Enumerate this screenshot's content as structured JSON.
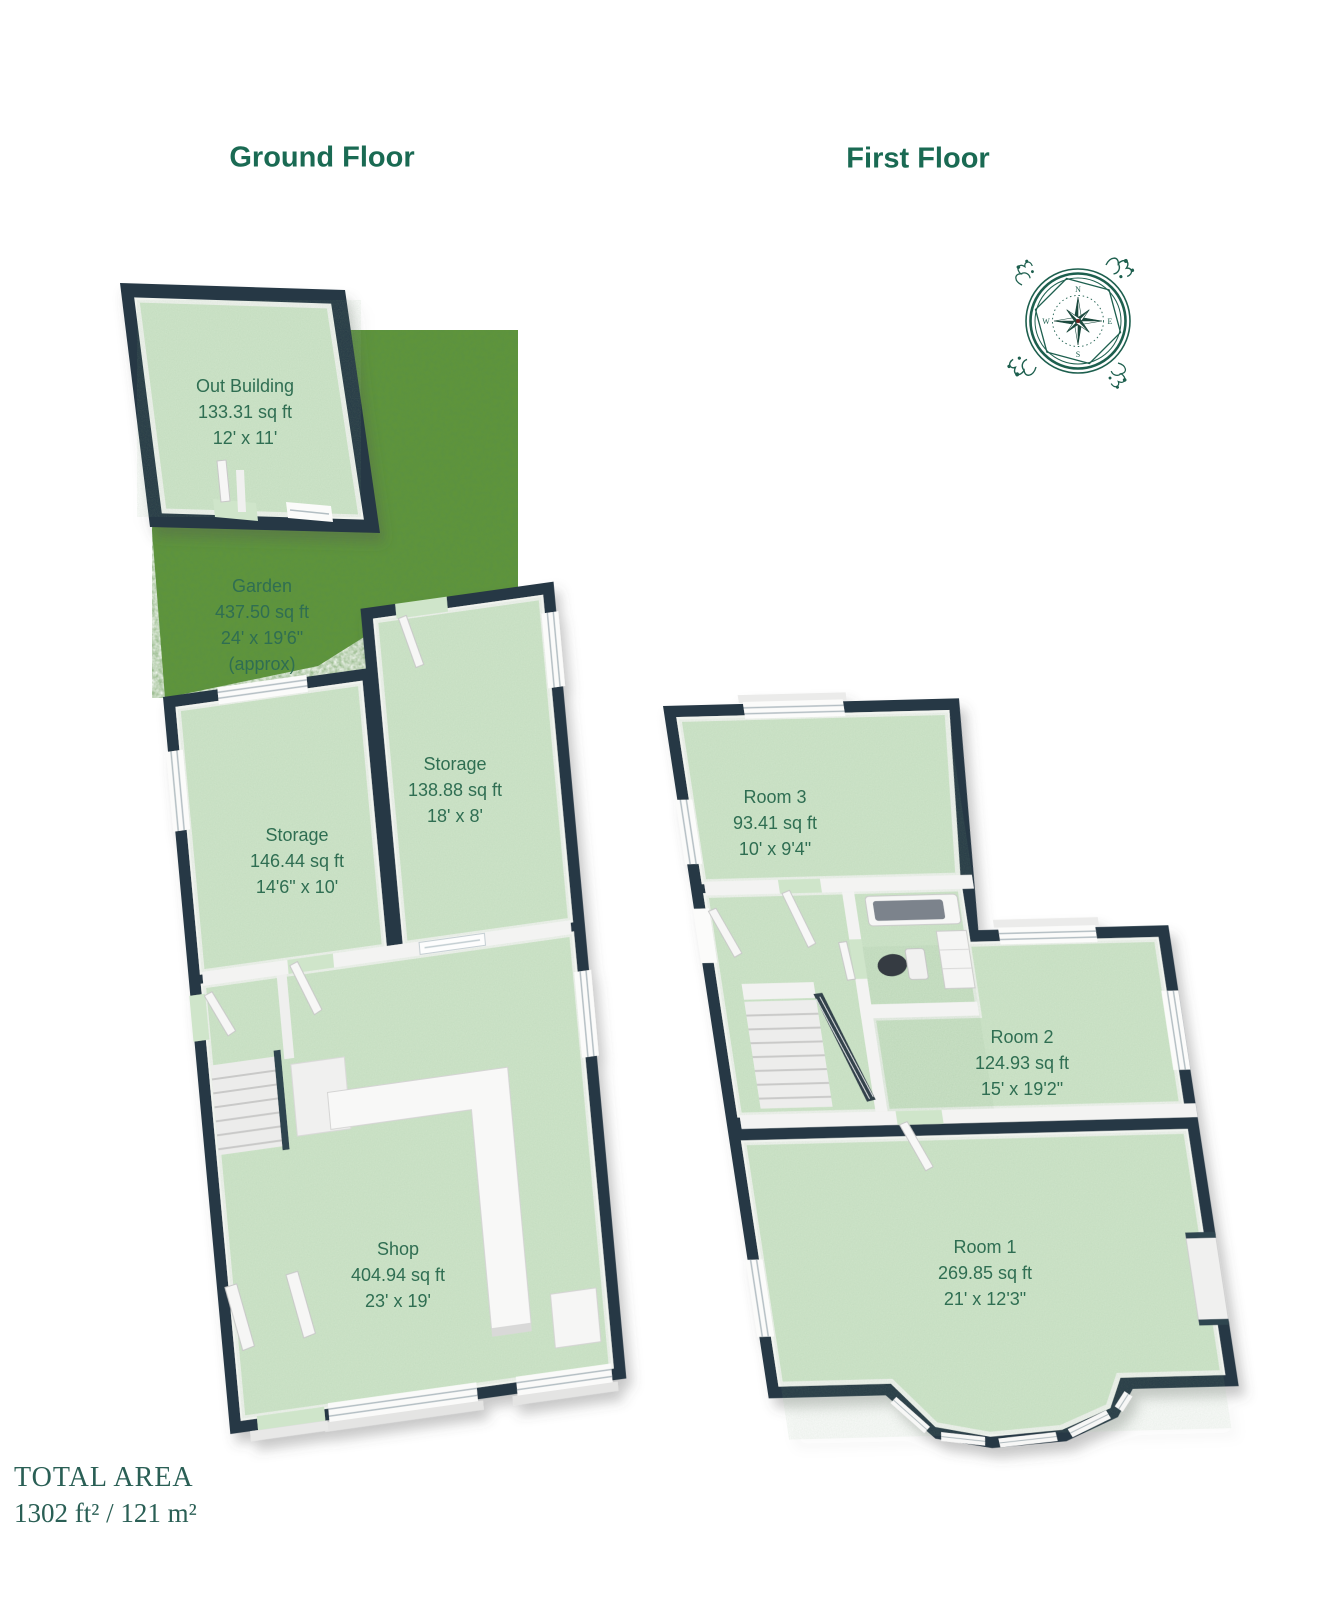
{
  "floors": [
    {
      "title": "Ground Floor",
      "rooms": [
        {
          "name": "Out Building",
          "area": "133.31 sq ft",
          "dims": "12' x 11'"
        },
        {
          "name": "Garden",
          "area": "437.50 sq ft",
          "dims": "24' x 19'6\"",
          "note": "(approx)"
        },
        {
          "name": "Storage",
          "area": "146.44 sq ft",
          "dims": "14'6\" x 10'"
        },
        {
          "name": "Storage",
          "area": "138.88 sq ft",
          "dims": "18' x 8'"
        },
        {
          "name": "Shop",
          "area": "404.94 sq ft",
          "dims": "23' x 19'"
        }
      ]
    },
    {
      "title": "First Floor",
      "rooms": [
        {
          "name": "Room 3",
          "area": "93.41 sq ft",
          "dims": "10' x 9'4\""
        },
        {
          "name": "Room 2",
          "area": "124.93 sq ft",
          "dims": "15' x 19'2\""
        },
        {
          "name": "Room 1",
          "area": "269.85 sq ft",
          "dims": "21' x 12'3\""
        }
      ]
    }
  ],
  "footer": {
    "total_area_label": "TOTAL AREA",
    "total_area_value": "1302 ft² / 121 m²"
  },
  "icons": {
    "compass": "compass-rose-icon"
  },
  "colors": {
    "title_green": "#1a6a53",
    "label_green": "#2f6e52",
    "footer_green": "#2a5f55",
    "wall_dark": "#253845",
    "floor_green": "#cfe5ca",
    "grass_green": "#609539",
    "compass_green": "#1d5f4e"
  }
}
